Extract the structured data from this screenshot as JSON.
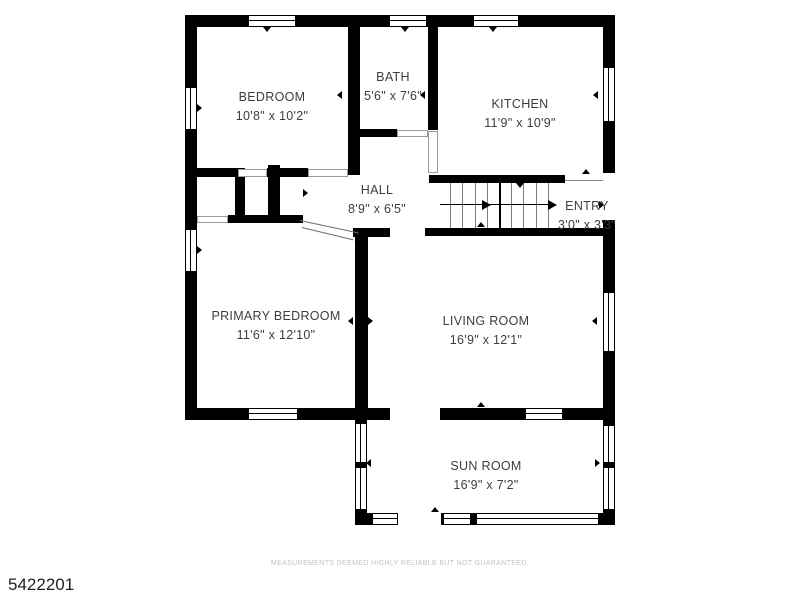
{
  "floorplan": {
    "rooms": [
      {
        "name": "BEDROOM",
        "dimensions": "10'8\" x 10'2\""
      },
      {
        "name": "BATH",
        "dimensions": "5'6\" x 7'6\""
      },
      {
        "name": "KITCHEN",
        "dimensions": "11'9\" x 10'9\""
      },
      {
        "name": "HALL",
        "dimensions": "8'9\" x 6'5\""
      },
      {
        "name": "ENTRY",
        "dimensions": "3'0\" x 3'3\""
      },
      {
        "name": "PRIMARY BEDROOM",
        "dimensions": "11'6\" x 12'10\""
      },
      {
        "name": "LIVING ROOM",
        "dimensions": "16'9\" x 12'1\""
      },
      {
        "name": "SUN ROOM",
        "dimensions": "16'9\" x 7'2\""
      }
    ],
    "footer": {
      "listing_id": "5422201",
      "disclaimer": "MEASUREMENTS DEEMED HIGHLY RELIABLE BUT NOT GUARANTEED."
    },
    "colors": {
      "wall": "#000000",
      "label_text": "#3d3d3d",
      "disclaimer_text": "#c2c2c2",
      "background": "#ffffff"
    }
  }
}
